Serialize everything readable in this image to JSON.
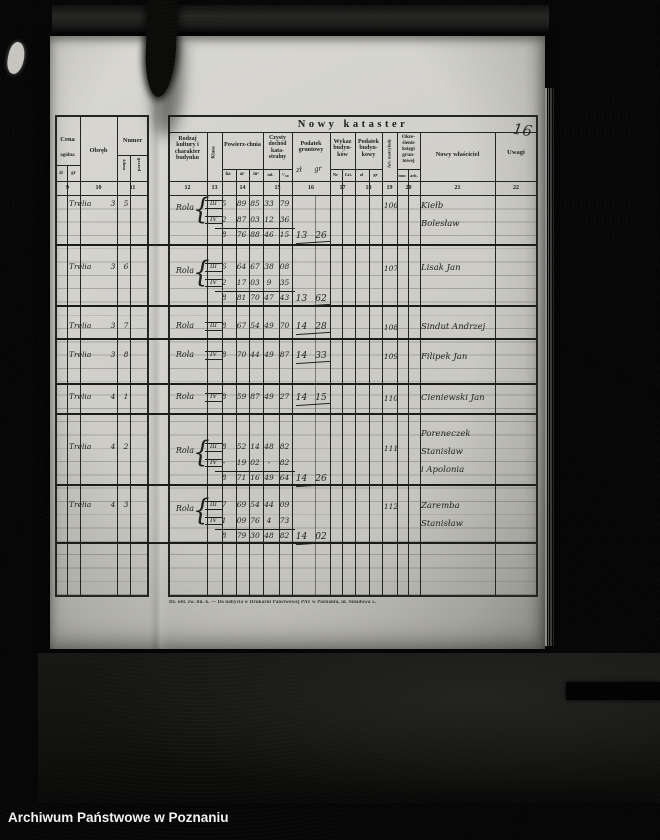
{
  "archive_footer": "Archiwum Państwowe w Poznaniu",
  "page_number": "16",
  "colors": {
    "page": "#d3d2cd",
    "ink": "#1c1c1a",
    "background": "#060606",
    "archive_text": "#f2f2f2"
  },
  "table": {
    "title": "Nowy kataster",
    "left_columns": {
      "cena": {
        "label": "Cena",
        "sub": "ogólna",
        "units": [
          "zł",
          "gr"
        ],
        "num": "9"
      },
      "obreb": {
        "label": "Obręb",
        "num": "10"
      },
      "numer": {
        "label": "Numer",
        "subs": [
          "mapy",
          "parceli"
        ],
        "num": "11"
      }
    },
    "columns": [
      {
        "num": "12",
        "label": "Rodzaj kultury i charakter budynku"
      },
      {
        "num": "13",
        "label": "Klasa"
      },
      {
        "num": "14",
        "label": "Powierz-chnia",
        "units": [
          "ha",
          "ar",
          "m²"
        ]
      },
      {
        "num": "15",
        "label": "Czysty dochód kata-stralny",
        "units": [
          "tal.",
          "¹/₁₀₀"
        ]
      },
      {
        "num": "16",
        "label": "Podatek gruntowy",
        "handwritten_units": [
          "zł",
          "gr"
        ]
      },
      {
        "num": "17",
        "label": "Wykaz budyn-ków",
        "units": [
          "Nr",
          "Lit."
        ]
      },
      {
        "num": "18",
        "label": "Podatek budyn-kowy",
        "units": [
          "zł",
          "gr"
        ]
      },
      {
        "num": "19",
        "label": "Art. matrykuły"
      },
      {
        "num": "20",
        "label": "Okre-ślenie księgi grun-towej",
        "units": [
          "tom",
          "ark."
        ]
      },
      {
        "num": "21",
        "label": "Nowy właściciel"
      },
      {
        "num": "22",
        "label": "Uwagi"
      }
    ],
    "footer_note": "Dz. obl. zw. lin. k. — Do nabycia w Drukarni Państwowej PAT w Poznaniu, ul. Składowa 5."
  },
  "entries": [
    {
      "obreb": "Trelia",
      "mapa": "3",
      "parcela": "5",
      "kultura": "Rola",
      "art": "106",
      "lines": [
        {
          "klasa": "III",
          "ha": "5",
          "ar": "89",
          "m2": "85",
          "tal": "33",
          "setne": "79"
        },
        {
          "klasa": "IV",
          "ha": "2",
          "ar": "87",
          "m2": "03",
          "tal": "12",
          "setne": "36"
        }
      ],
      "sum": {
        "ha": "8",
        "ar": "76",
        "m2": "88",
        "tal": "46",
        "setne": "15"
      },
      "podatek": {
        "zl": "13",
        "gr": "26"
      },
      "owner": [
        "Kiełb",
        "Bolesław"
      ]
    },
    {
      "obreb": "Trelia",
      "mapa": "3",
      "parcela": "6",
      "kultura": "Rola",
      "art": "107",
      "lines": [
        {
          "klasa": "III",
          "ha": "6",
          "ar": "64",
          "m2": "67",
          "tal": "38",
          "setne": "08"
        },
        {
          "klasa": "IV",
          "ha": "2",
          "ar": "17",
          "m2": "03",
          "tal": "9",
          "setne": "35"
        }
      ],
      "sum": {
        "ha": "8",
        "ar": "81",
        "m2": "70",
        "tal": "47",
        "setne": "43"
      },
      "podatek": {
        "zl": "13",
        "gr": "62"
      },
      "owner": [
        "Lisak Jan"
      ]
    },
    {
      "obreb": "Trelia",
      "mapa": "3",
      "parcela": "7",
      "kultura": "Rola",
      "art": "108",
      "lines": [
        {
          "klasa": "III",
          "ha": "8",
          "ar": "67",
          "m2": "54",
          "tal": "49",
          "setne": "70"
        }
      ],
      "podatek": {
        "zl": "14",
        "gr": "28"
      },
      "owner": [
        "Sindut Andrzej"
      ]
    },
    {
      "obreb": "Trelia",
      "mapa": "3",
      "parcela": "8",
      "kultura": "Rola",
      "art": "109",
      "lines": [
        {
          "klasa": "IV",
          "ha": "8",
          "ar": "70",
          "m2": "44",
          "tal": "49",
          "setne": "87"
        }
      ],
      "podatek": {
        "zl": "14",
        "gr": "33"
      },
      "owner": [
        "Filipek Jan"
      ]
    },
    {
      "obreb": "Trelia",
      "mapa": "4",
      "parcela": "1",
      "kultura": "Rola",
      "art": "110",
      "lines": [
        {
          "klasa": "IV",
          "ha": "8",
          "ar": "59",
          "m2": "87",
          "tal": "49",
          "setne": "27"
        }
      ],
      "podatek": {
        "zl": "14",
        "gr": "15"
      },
      "owner": [
        "Cieniewski Jan"
      ]
    },
    {
      "obreb": "Trelia",
      "mapa": "4",
      "parcela": "2",
      "kultura": "Rola",
      "art": "111",
      "lines": [
        {
          "klasa": "III",
          "ha": "8",
          "ar": "52",
          "m2": "14",
          "tal": "48",
          "setne": "82"
        },
        {
          "klasa": "IV",
          "ha": "-",
          "ar": "19",
          "m2": "02",
          "tal": "-",
          "setne": "82"
        }
      ],
      "sum": {
        "ha": "8",
        "ar": "71",
        "m2": "16",
        "tal": "49",
        "setne": "64"
      },
      "podatek": {
        "zl": "14",
        "gr": "26"
      },
      "owner": [
        "Poreneczek",
        "Stanisław",
        "i Apolonia"
      ]
    },
    {
      "obreb": "Trelia",
      "mapa": "4",
      "parcela": "3",
      "kultura": "Rola",
      "art": "112",
      "lines": [
        {
          "klasa": "III",
          "ha": "7",
          "ar": "69",
          "m2": "54",
          "tal": "44",
          "setne": "09"
        },
        {
          "klasa": "IV",
          "ha": "1",
          "ar": "09",
          "m2": "76",
          "tal": "4",
          "setne": "73"
        }
      ],
      "sum": {
        "ha": "8",
        "ar": "79",
        "m2": "30",
        "tal": "48",
        "setne": "82"
      },
      "podatek": {
        "zl": "14",
        "gr": "02"
      },
      "owner": [
        "Zaremba",
        "Stanisław"
      ]
    }
  ]
}
